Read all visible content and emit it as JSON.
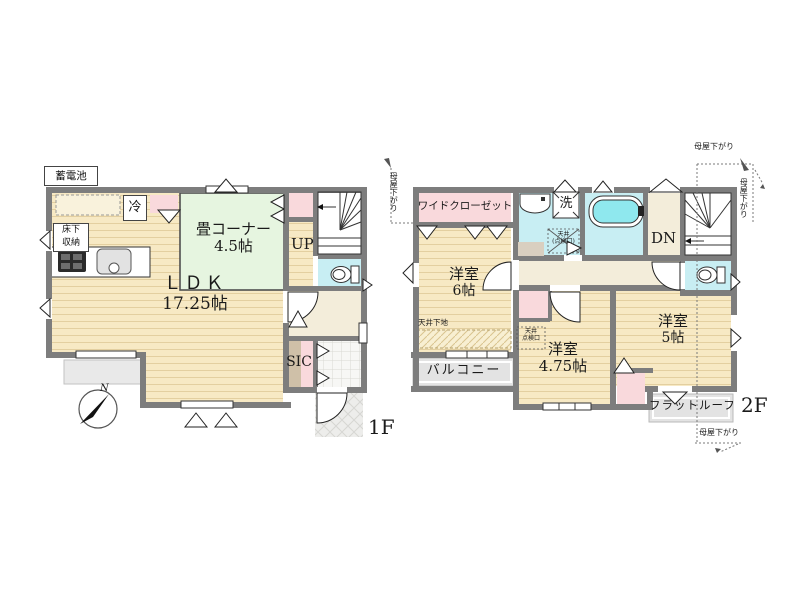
{
  "floor1": {
    "floor_label": "1F",
    "battery_label": "蓄電池",
    "fridge_label": "冷",
    "floor_storage_line1": "床下",
    "floor_storage_line2": "収納",
    "tatami_name": "畳コーナー",
    "tatami_size": "4.5帖",
    "up_label": "UP",
    "ldk_name": "ＬＤＫ",
    "ldk_size": "17.25帖",
    "sic_label": "SIC",
    "compass_north": "N"
  },
  "floor2": {
    "floor_label": "2F",
    "wide_closet_label": "ワイドクローゼット",
    "washer_label": "洗",
    "hatch_wash_line1": "天井",
    "hatch_wash_line2": "(点検口)",
    "dn_label": "DN",
    "room6_name": "洋室",
    "room6_size": "6帖",
    "ceiling_base_label": "天井下地",
    "balcony_label": "バルコニー",
    "hatch_475_line1": "天井",
    "hatch_475_line2": "点検口",
    "room475_name": "洋室",
    "room475_size": "4.75帖",
    "room5_name": "洋室",
    "room5_size": "5帖",
    "flat_roof_label": "フラットルーフ",
    "moya_sagari_top": "母屋下がり",
    "moya_sagari_right": "母屋下がり",
    "moya_sagari_left": "母屋下がり",
    "moya_sagari_bottom": "母屋下がり"
  },
  "colors": {
    "wall": "#7d7d7d",
    "wood": "#f7e9c4",
    "tatami": "#e6f5e0",
    "wet_cyan": "#c8eef3",
    "closet_pink": "#f9d9dc",
    "hall_cream": "#f3edda",
    "balcony_gray": "#e3e3e3"
  }
}
